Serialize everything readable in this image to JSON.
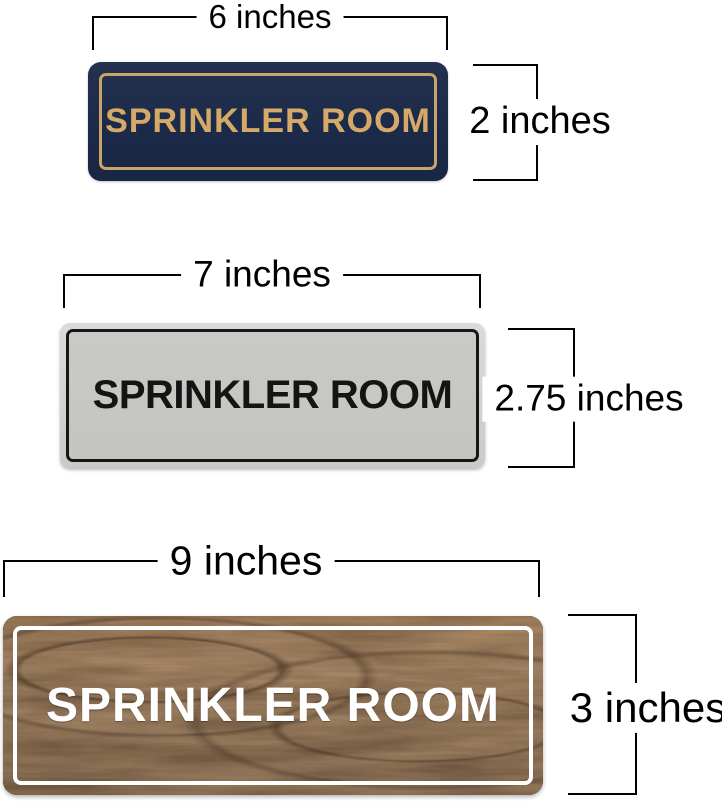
{
  "signs": [
    {
      "name": "navy-gold-sign",
      "label": "SPRINKLER ROOM",
      "width_label": "6 inches",
      "height_label": "2 inches",
      "colors": {
        "background": "#1d2b4a",
        "border": "#c8a469",
        "text": "#d5aa68"
      }
    },
    {
      "name": "silver-black-sign",
      "label": "SPRINKLER ROOM",
      "width_label": "7 inches",
      "height_label": "2.75 inches",
      "colors": {
        "background": "#c5c6c1",
        "rim": "#d2d3d0",
        "border": "#161616",
        "text": "#141414"
      }
    },
    {
      "name": "walnut-white-sign",
      "label": "SPRINKLER ROOM",
      "width_label": "9 inches",
      "height_label": "3 inches",
      "colors": {
        "background": "#4f3823",
        "border": "#ffffff",
        "text": "#ffffff"
      }
    }
  ],
  "dimension_lines": {
    "color": "#000000"
  }
}
